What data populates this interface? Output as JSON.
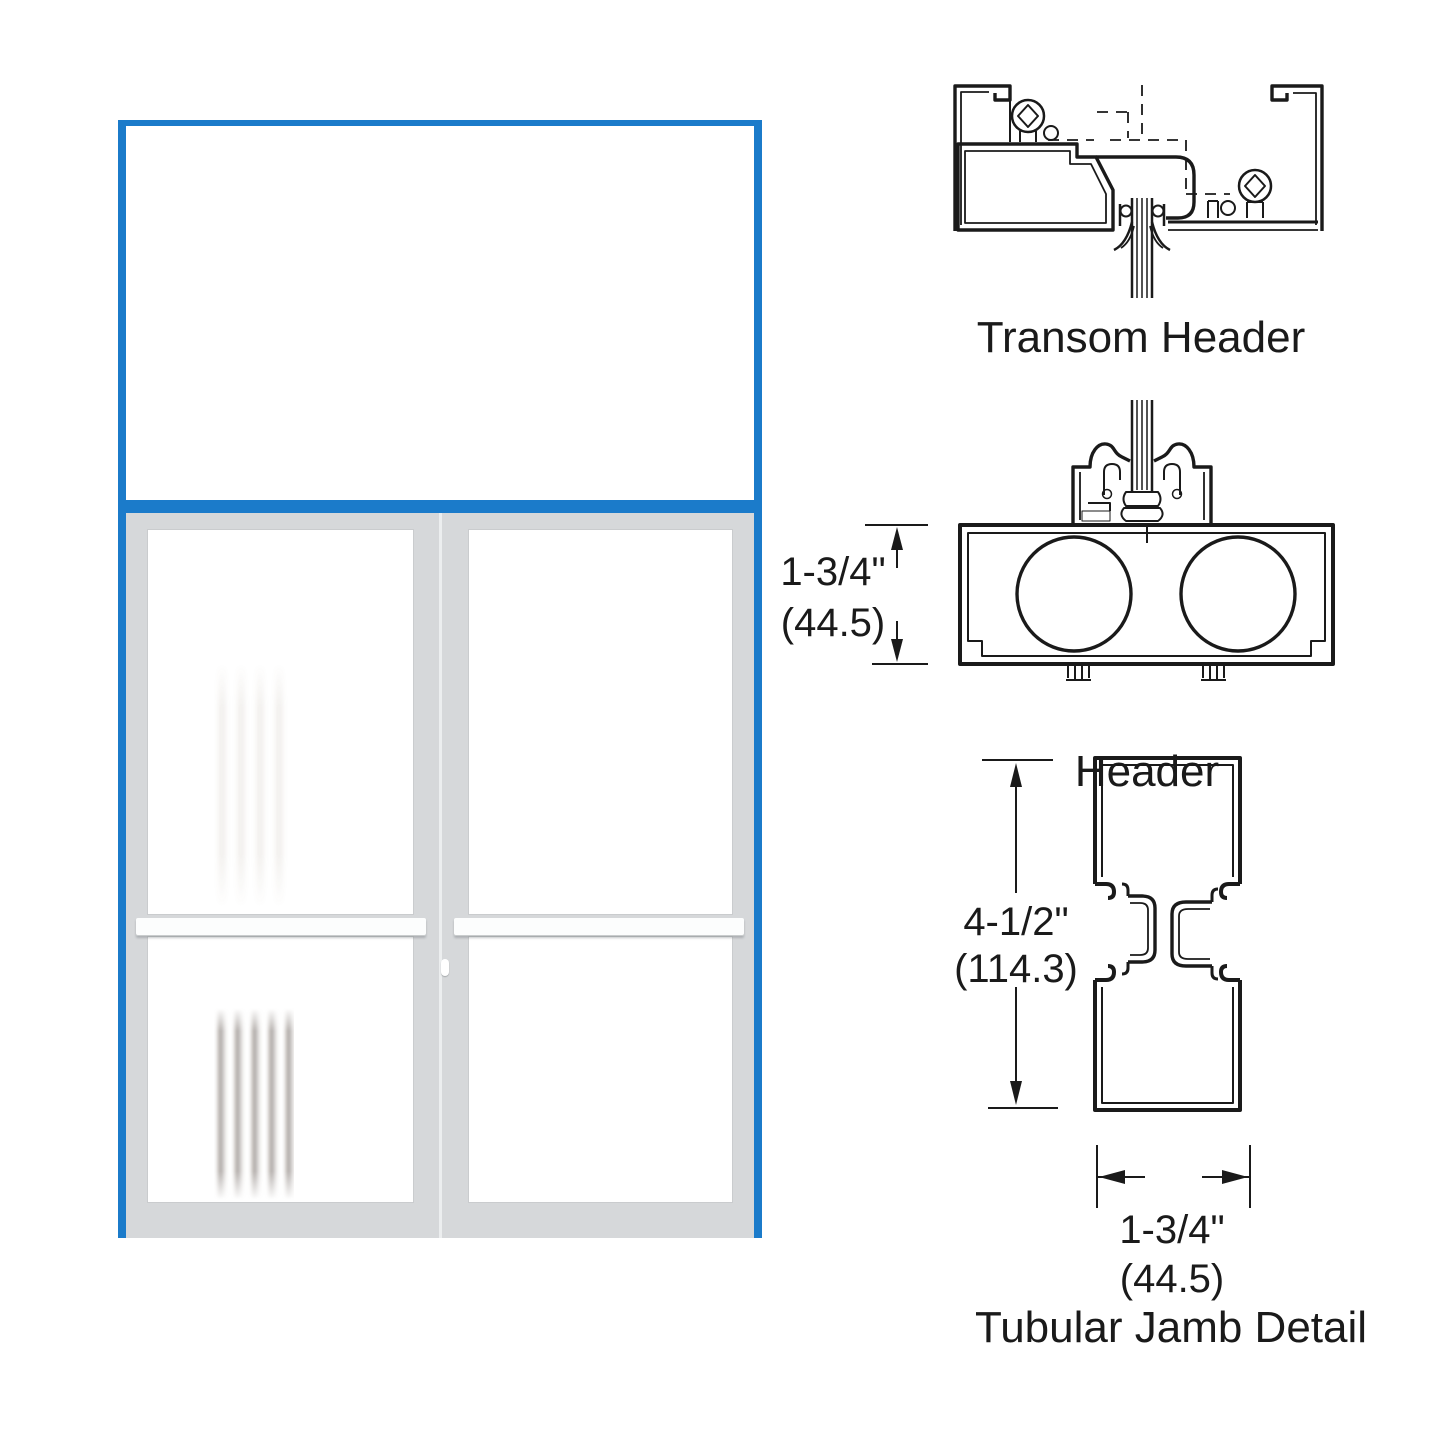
{
  "diagram": {
    "labels": {
      "transom_header": "Transom Header",
      "header": "Header",
      "jamb": "Tubular Jamb Detail"
    },
    "dimensions": {
      "header": {
        "imperial": "1-3/4\"",
        "metric": "(44.5)"
      },
      "jamb_height": {
        "imperial": "4-1/2\"",
        "metric": "(114.3)"
      },
      "jamb_width": {
        "imperial": "1-3/4\"",
        "metric": "(44.5)"
      }
    },
    "colors": {
      "frame_blue": "#1b7bca",
      "door_gray": "#d6d8da",
      "glass_white": "#ffffff",
      "line_black": "#1a1a1a"
    }
  }
}
